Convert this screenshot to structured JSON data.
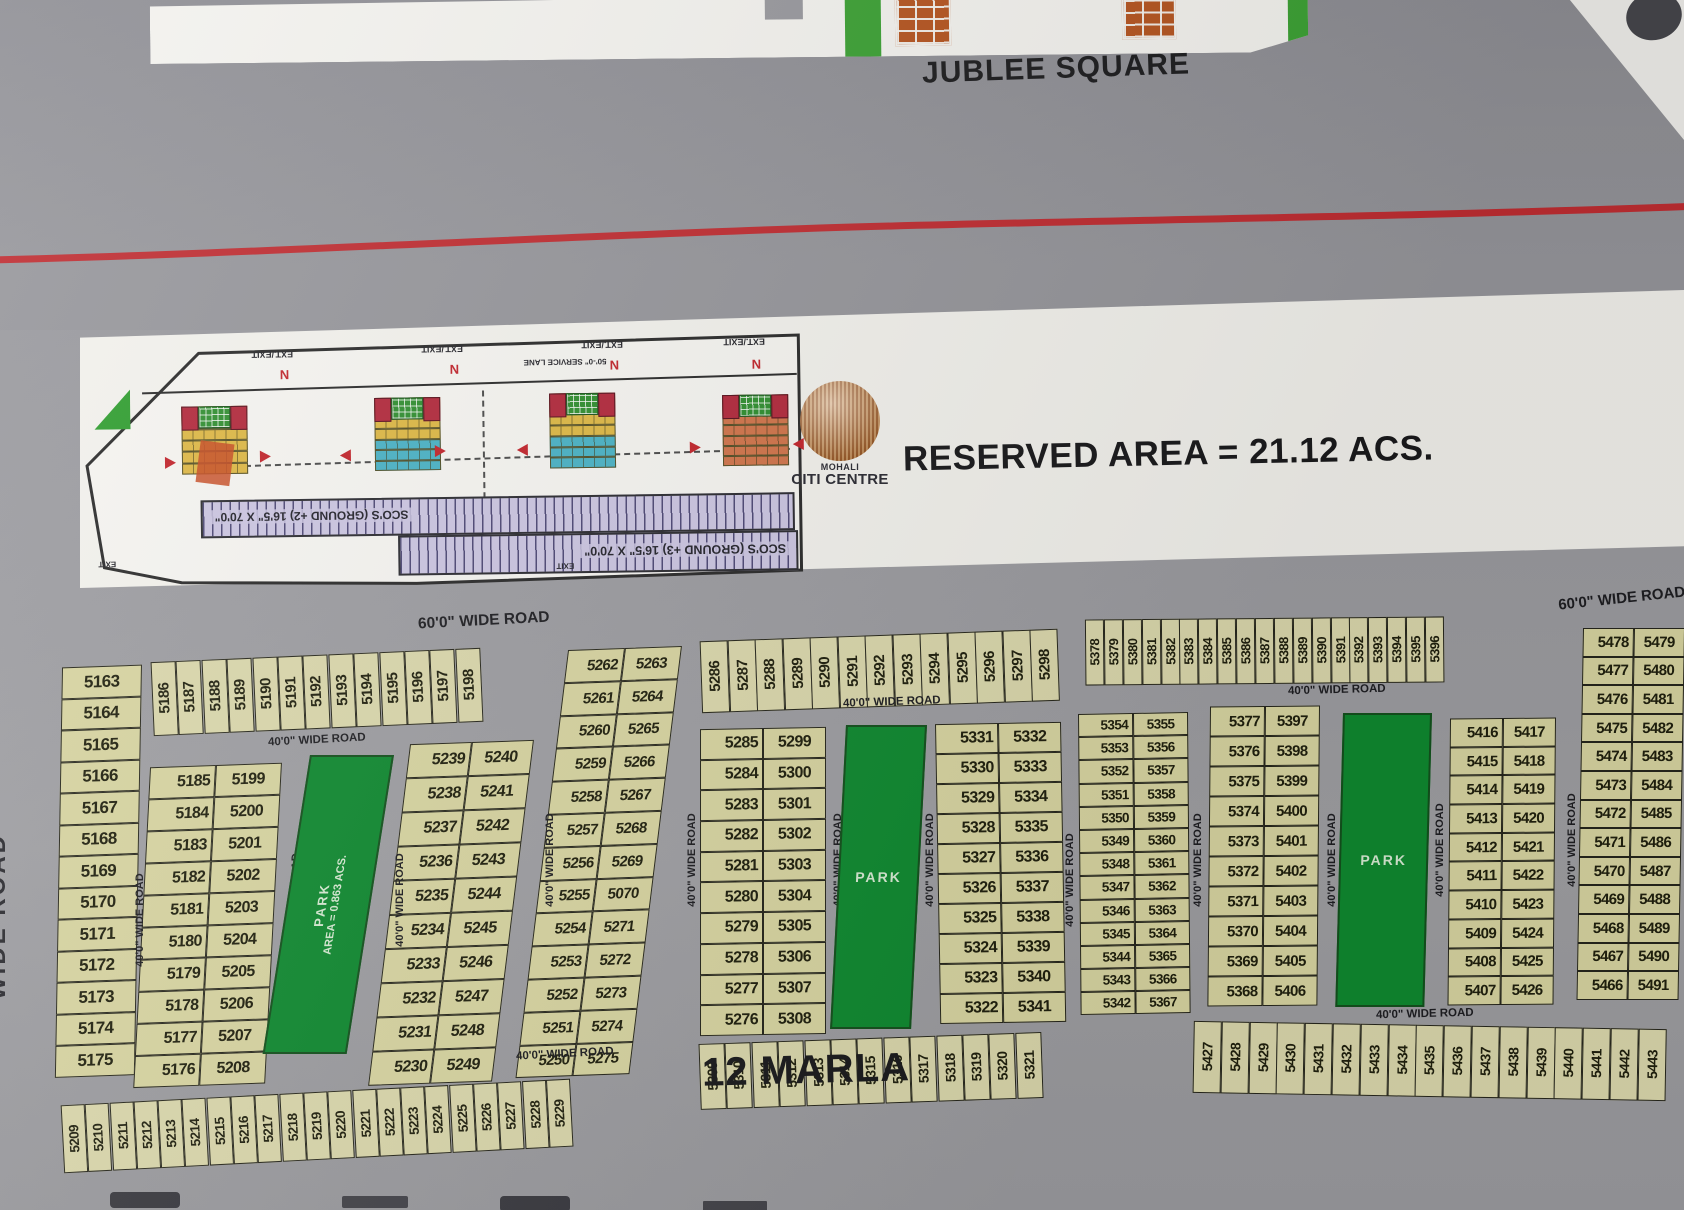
{
  "header": {
    "square_label": "JUBLEE SQUARE"
  },
  "reserved": {
    "label": "RESERVED AREA = 21.12 ACS."
  },
  "logo": {
    "name_line1": "MOHALI",
    "name_line2": "CITI CENTRE"
  },
  "marla_label": "12 MARLA",
  "roads": {
    "w60": "60'0\" WIDE ROAD",
    "w40": "40'0\" WIDE ROAD",
    "left_edge": "WIDE ROAD"
  },
  "parks": {
    "p1_name": "PARK",
    "p1_area": "AREA = 0.863 ACS.",
    "p2_name": "PARK",
    "p3_name": "PARK"
  },
  "inset": {
    "ext_exit": "EXT./EXIT",
    "service_lane": "50'-0\" SERVICE LANE",
    "sco_ground2": "SCO'S (GROUND +2) 16'5\" X 70'0\"",
    "sco_ground3": "SCO'S (GROUND +3) 16'5\" X 70'0\"",
    "exit": "EXIT",
    "north": "N"
  },
  "plots": {
    "col_5163": [
      "5163",
      "5164",
      "5165",
      "5166",
      "5167",
      "5168",
      "5169",
      "5170",
      "5171",
      "5172",
      "5173",
      "5174",
      "5175"
    ],
    "row_5186": [
      "5186",
      "5187",
      "5188",
      "5189",
      "5190",
      "5191",
      "5192",
      "5193",
      "5194",
      "5195",
      "5196",
      "5197",
      "5198"
    ],
    "pairs_5185_5208": [
      [
        "5185",
        "5199"
      ],
      [
        "5184",
        "5200"
      ],
      [
        "5183",
        "5201"
      ],
      [
        "5182",
        "5202"
      ],
      [
        "5181",
        "5203"
      ],
      [
        "5180",
        "5204"
      ],
      [
        "5179",
        "5205"
      ],
      [
        "5178",
        "5206"
      ],
      [
        "5177",
        "5207"
      ],
      [
        "5176",
        "5208"
      ]
    ],
    "pairs_5230_5249": [
      [
        "5239",
        "5240"
      ],
      [
        "5238",
        "5241"
      ],
      [
        "5237",
        "5242"
      ],
      [
        "5236",
        "5243"
      ],
      [
        "5235",
        "5244"
      ],
      [
        "5234",
        "5245"
      ],
      [
        "5233",
        "5246"
      ],
      [
        "5232",
        "5247"
      ],
      [
        "5231",
        "5248"
      ],
      [
        "5230",
        "5249"
      ]
    ],
    "pairs_5250_5275": [
      [
        "5262",
        "5263"
      ],
      [
        "5261",
        "5264"
      ],
      [
        "5260",
        "5265"
      ],
      [
        "5259",
        "5266"
      ],
      [
        "5258",
        "5267"
      ],
      [
        "5257",
        "5268"
      ],
      [
        "5256",
        "5269"
      ],
      [
        "5255",
        "5070"
      ],
      [
        "5254",
        "5271"
      ],
      [
        "5253",
        "5272"
      ],
      [
        "5252",
        "5273"
      ],
      [
        "5251",
        "5274"
      ],
      [
        "5250",
        "5275"
      ]
    ],
    "row_5286": [
      "5286",
      "5287",
      "5288",
      "5289",
      "5290",
      "5291",
      "5292",
      "5293",
      "5294",
      "5295",
      "5296",
      "5297",
      "5298"
    ],
    "pairs_5276_5308": [
      [
        "5285",
        "5299"
      ],
      [
        "5284",
        "5300"
      ],
      [
        "5283",
        "5301"
      ],
      [
        "5282",
        "5302"
      ],
      [
        "5281",
        "5303"
      ],
      [
        "5280",
        "5304"
      ],
      [
        "5279",
        "5305"
      ],
      [
        "5278",
        "5306"
      ],
      [
        "5277",
        "5307"
      ],
      [
        "5276",
        "5308"
      ]
    ],
    "pairs_5322_5341": [
      [
        "5331",
        "5332"
      ],
      [
        "5330",
        "5333"
      ],
      [
        "5329",
        "5334"
      ],
      [
        "5328",
        "5335"
      ],
      [
        "5327",
        "5336"
      ],
      [
        "5326",
        "5337"
      ],
      [
        "5325",
        "5338"
      ],
      [
        "5324",
        "5339"
      ],
      [
        "5323",
        "5340"
      ],
      [
        "5322",
        "5341"
      ]
    ],
    "pairs_5342_5367": [
      [
        "5354",
        "5355"
      ],
      [
        "5353",
        "5356"
      ],
      [
        "5352",
        "5357"
      ],
      [
        "5351",
        "5358"
      ],
      [
        "5350",
        "5359"
      ],
      [
        "5349",
        "5360"
      ],
      [
        "5348",
        "5361"
      ],
      [
        "5347",
        "5362"
      ],
      [
        "5346",
        "5363"
      ],
      [
        "5345",
        "5364"
      ],
      [
        "5344",
        "5365"
      ],
      [
        "5343",
        "5366"
      ],
      [
        "5342",
        "5367"
      ]
    ],
    "row_5378": [
      "5378",
      "5379",
      "5380",
      "5381",
      "5382",
      "5383",
      "5384",
      "5385",
      "5386",
      "5387",
      "5388",
      "5389",
      "5390",
      "5391",
      "5392",
      "5393",
      "5394",
      "5395",
      "5396"
    ],
    "pairs_5368_5406": [
      [
        "5377",
        "5397"
      ],
      [
        "5376",
        "5398"
      ],
      [
        "5375",
        "5399"
      ],
      [
        "5374",
        "5400"
      ],
      [
        "5373",
        "5401"
      ],
      [
        "5372",
        "5402"
      ],
      [
        "5371",
        "5403"
      ],
      [
        "5370",
        "5404"
      ],
      [
        "5369",
        "5405"
      ],
      [
        "5368",
        "5406"
      ]
    ],
    "pairs_5407_5426": [
      [
        "5416",
        "5417"
      ],
      [
        "5415",
        "5418"
      ],
      [
        "5414",
        "5419"
      ],
      [
        "5413",
        "5420"
      ],
      [
        "5412",
        "5421"
      ],
      [
        "5411",
        "5422"
      ],
      [
        "5410",
        "5423"
      ],
      [
        "5409",
        "5424"
      ],
      [
        "5408",
        "5425"
      ],
      [
        "5407",
        "5426"
      ]
    ],
    "pairs_5466_5491": [
      [
        "5478",
        "5479"
      ],
      [
        "5477",
        "5480"
      ],
      [
        "5476",
        "5481"
      ],
      [
        "5475",
        "5482"
      ],
      [
        "5474",
        "5483"
      ],
      [
        "5473",
        "5484"
      ],
      [
        "5472",
        "5485"
      ],
      [
        "5471",
        "5486"
      ],
      [
        "5470",
        "5487"
      ],
      [
        "5469",
        "5488"
      ],
      [
        "5468",
        "5489"
      ],
      [
        "5467",
        "5490"
      ],
      [
        "5466",
        "5491"
      ]
    ],
    "row_5309": [
      "5309",
      "5310",
      "5311",
      "5312",
      "5313",
      "5314",
      "5315",
      "5316",
      "5317",
      "5318",
      "5319",
      "5320",
      "5321"
    ],
    "row_5427": [
      "5427",
      "5428",
      "5429",
      "5430",
      "5431",
      "5432",
      "5433",
      "5434",
      "5435",
      "5436",
      "5437",
      "5438",
      "5439",
      "5440",
      "5441",
      "5442",
      "5443"
    ],
    "row_5209": [
      "5209",
      "5210",
      "5211",
      "5212",
      "5213",
      "5214",
      "5215",
      "5216",
      "5217",
      "5218",
      "5219",
      "5220",
      "5221",
      "5222",
      "5223",
      "5224",
      "5225",
      "5226",
      "5227",
      "5228",
      "5229"
    ]
  }
}
